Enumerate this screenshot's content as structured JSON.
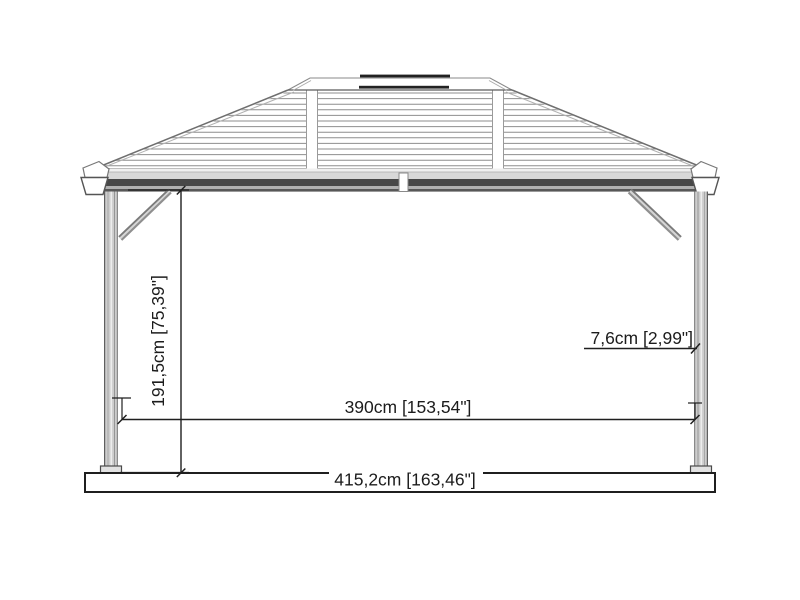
{
  "drawing": {
    "subject": "gazebo-side-elevation"
  },
  "dimensions": {
    "height": "191,5cm [75,39\"]",
    "inner_width": "390cm [153,54\"]",
    "total_width": "415,2cm [163,46\"]",
    "post_width": "7,6cm [2,99\"]"
  },
  "colors": {
    "line": "#1f1f1f",
    "roof_slat": "#8e8e8e",
    "roof_edge": "#8a8a8a",
    "fascia_light": "#d8d8d8",
    "fascia_dark": "#474747",
    "post_fill": "#cdcdcd",
    "vent_bar": "#222222",
    "background": "#ffffff"
  }
}
